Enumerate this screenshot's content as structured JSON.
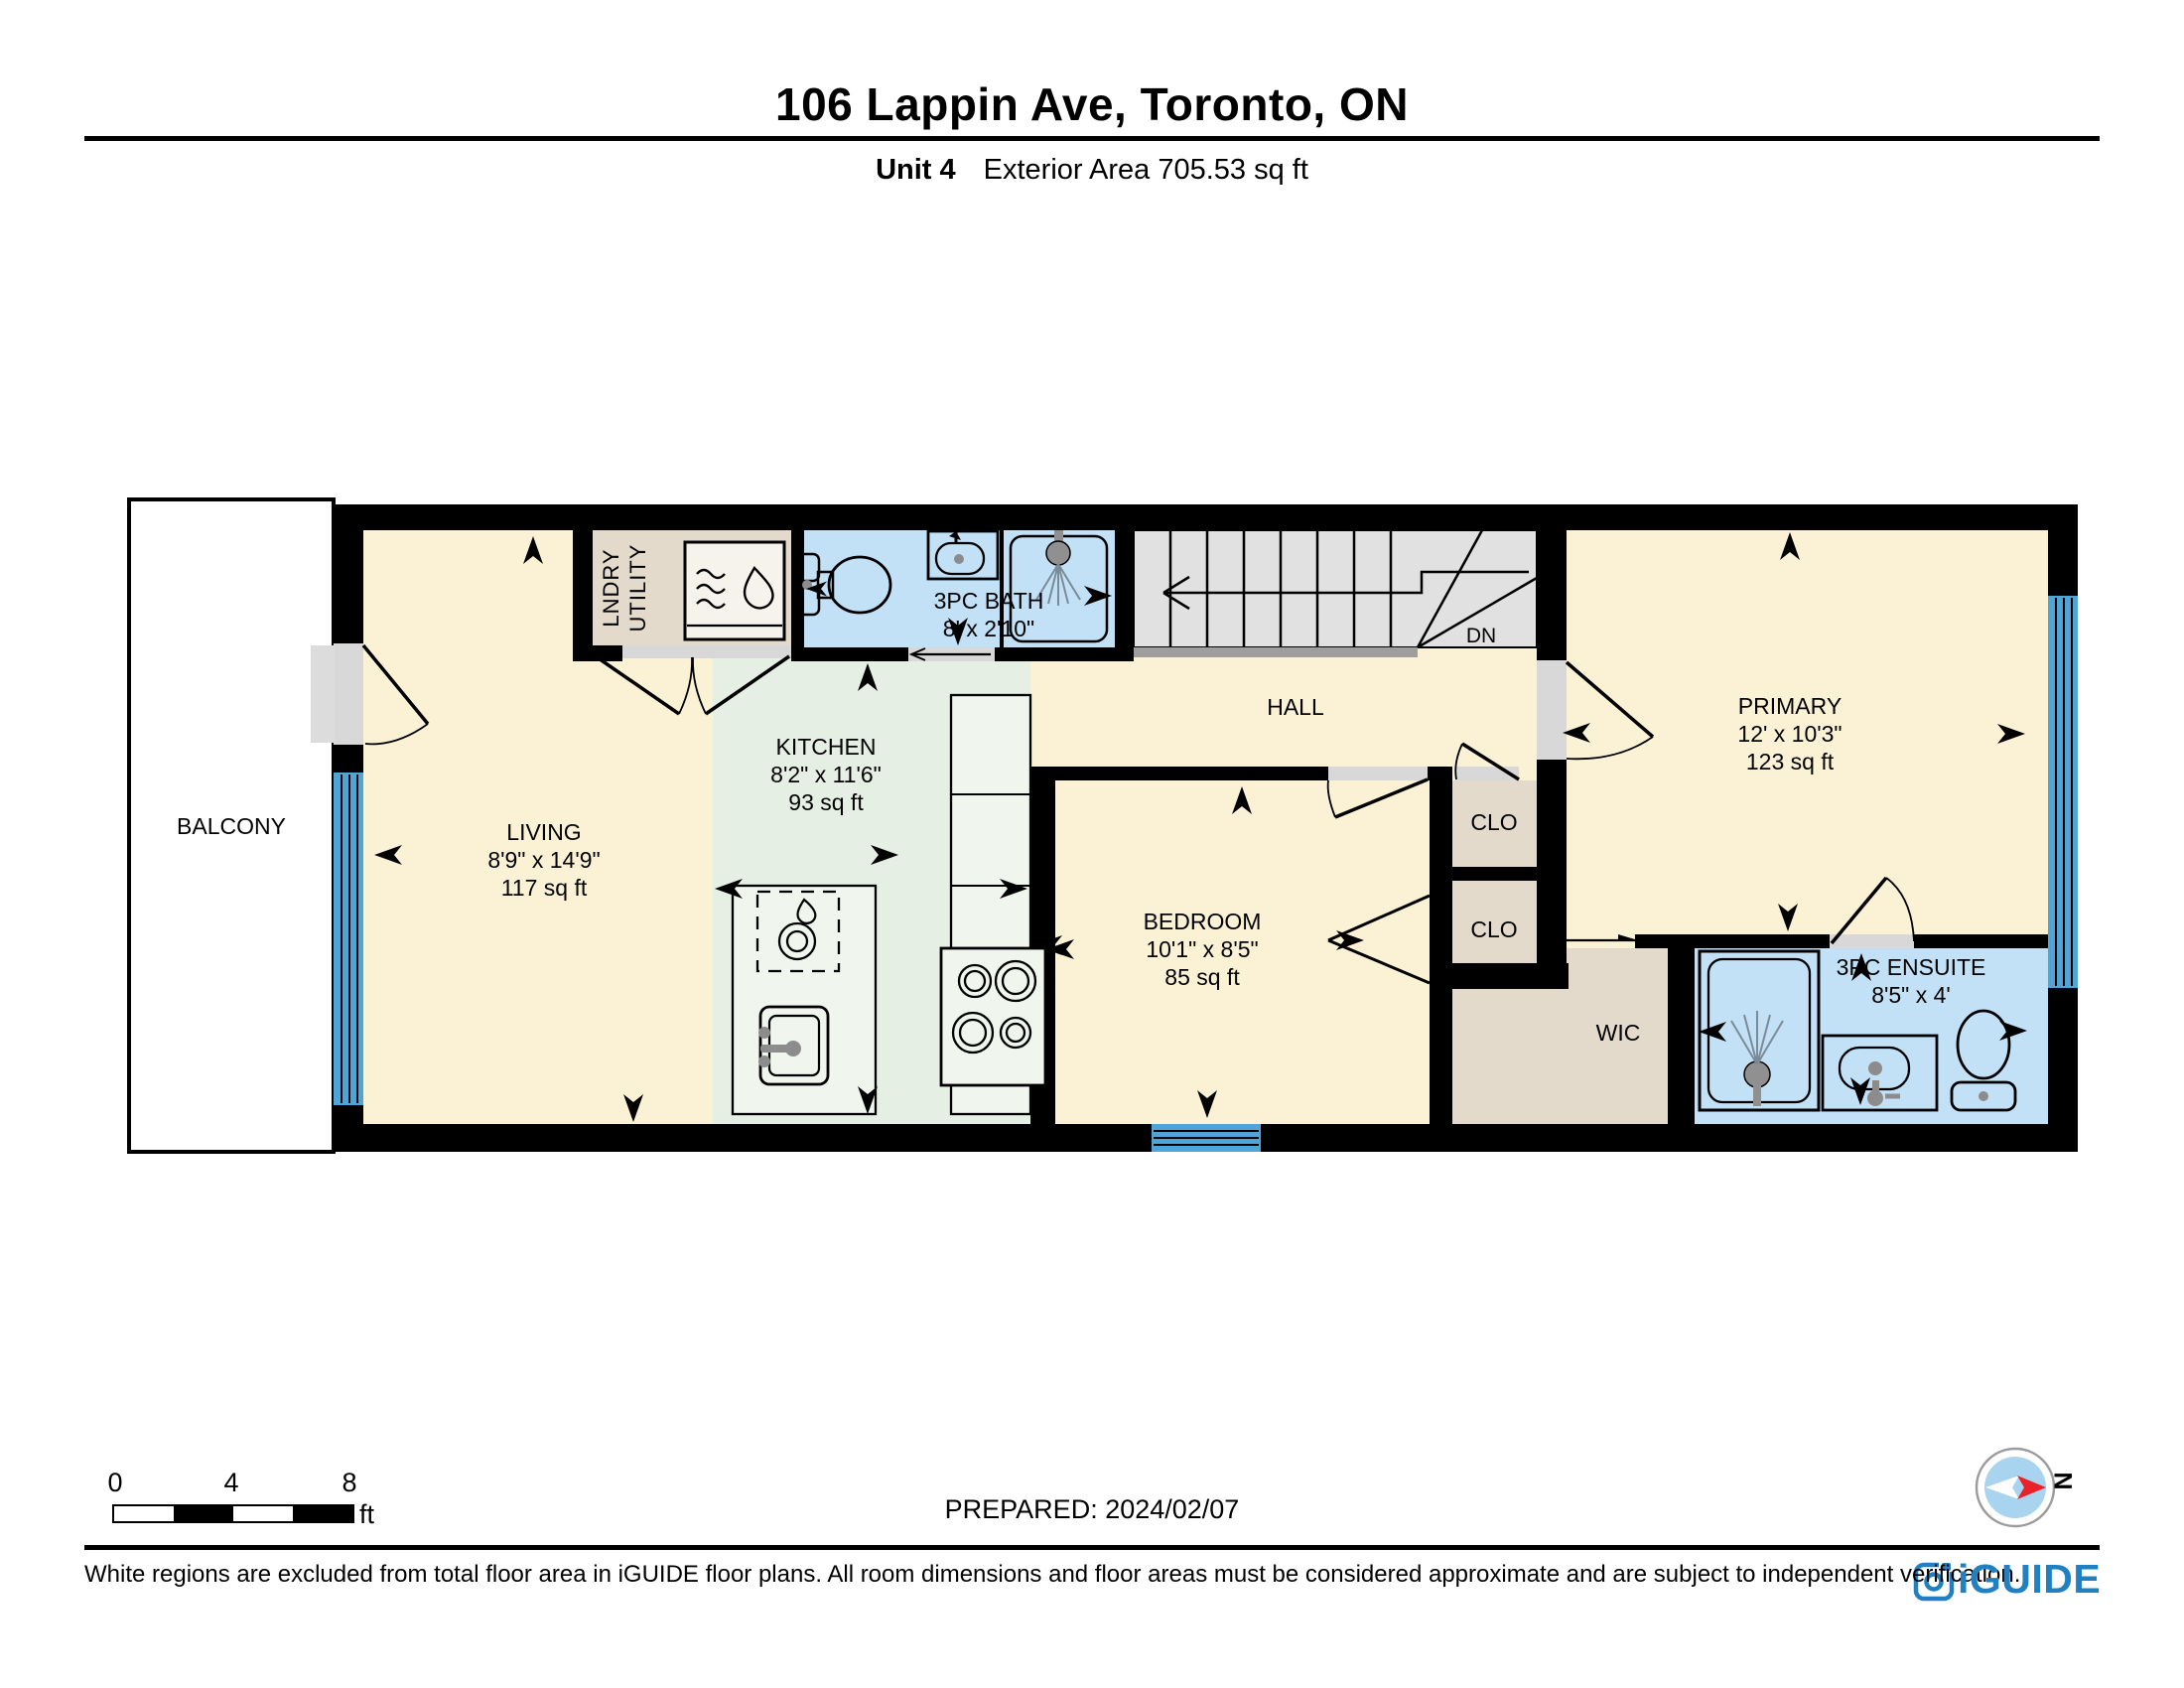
{
  "header": {
    "title": "106 Lappin Ave, Toronto, ON",
    "unit": "Unit 4",
    "area": "Exterior Area 705.53 sq ft"
  },
  "rooms": {
    "balcony": {
      "name": "BALCONY"
    },
    "living": {
      "name": "LIVING",
      "dims": "8'9\" x 14'9\"",
      "area": "117 sq ft"
    },
    "laundry": {
      "line1": "LNDRY",
      "line2": "UTILITY"
    },
    "kitchen": {
      "name": "KITCHEN",
      "dims": "8'2\" x 11'6\"",
      "area": "93 sq ft"
    },
    "bath": {
      "name": "3PC BATH",
      "dims": "8' x 2'10\""
    },
    "hall": {
      "name": "HALL"
    },
    "stairs": {
      "dn": "DN"
    },
    "bedroom": {
      "name": "BEDROOM",
      "dims": "10'1\" x 8'5\"",
      "area": "85 sq ft"
    },
    "closet_top": {
      "name": "CLO"
    },
    "closet_bottom": {
      "name": "CLO"
    },
    "wic": {
      "name": "WIC"
    },
    "primary": {
      "name": "PRIMARY",
      "dims": "12' x 10'3\"",
      "area": "123 sq ft"
    },
    "ensuite": {
      "name": "3PC ENSUITE",
      "dims": "8'5\" x 4'"
    }
  },
  "footer": {
    "scale": {
      "zero": "0",
      "four": "4",
      "eight": "8",
      "unit": "ft"
    },
    "prepared": "PREPARED: 2024/02/07",
    "compass": "N",
    "disclaimer": "White regions are excluded from total floor area in iGUIDE floor plans. All room dimensions and floor areas must be considered approximate and are subject to independent verification.",
    "brand": "iGUIDE"
  },
  "colors": {
    "room_cream": "#FBF2D6",
    "kitchen_green": "#E5EFE3",
    "bath_blue": "#C2E1F7",
    "closet_tan": "#E3DACB",
    "stairs_gray": "#E1E1E1",
    "window_blue": "#4FA5D8",
    "wall_black": "#000000",
    "brand_blue": "#2080C2",
    "compass_red": "#EC2027"
  }
}
